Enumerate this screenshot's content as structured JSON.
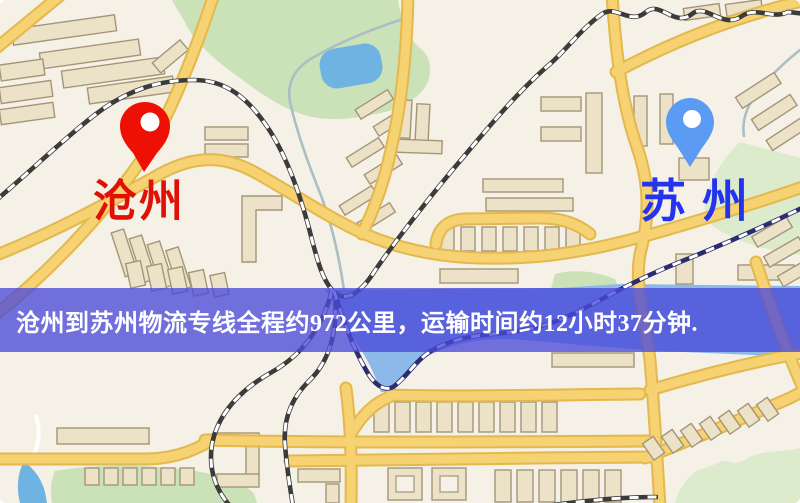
{
  "window": {
    "width": 800,
    "height": 503
  },
  "map": {
    "origin": {
      "label": "沧州",
      "pin_color": "#ee1004",
      "label_color": "#e01005"
    },
    "destination": {
      "label": "苏州",
      "pin_color": "#5b9bf3",
      "label_color": "#2433f0"
    }
  },
  "banner": {
    "text": "沧州到苏州物流专线全程约972公里，运输时间约12小时37分钟.",
    "background": "#4a4ad8",
    "text_color": "#ffffff"
  },
  "palette": {
    "land": "#f5f1e6",
    "park_green": "#cbe2b8",
    "water_blue": "#8cb8ea",
    "road_yellow": "#f6d272",
    "road_casing": "#e3b84e",
    "building_beige": "#ebe2c8",
    "railway_dark": "#3b3b3b"
  }
}
